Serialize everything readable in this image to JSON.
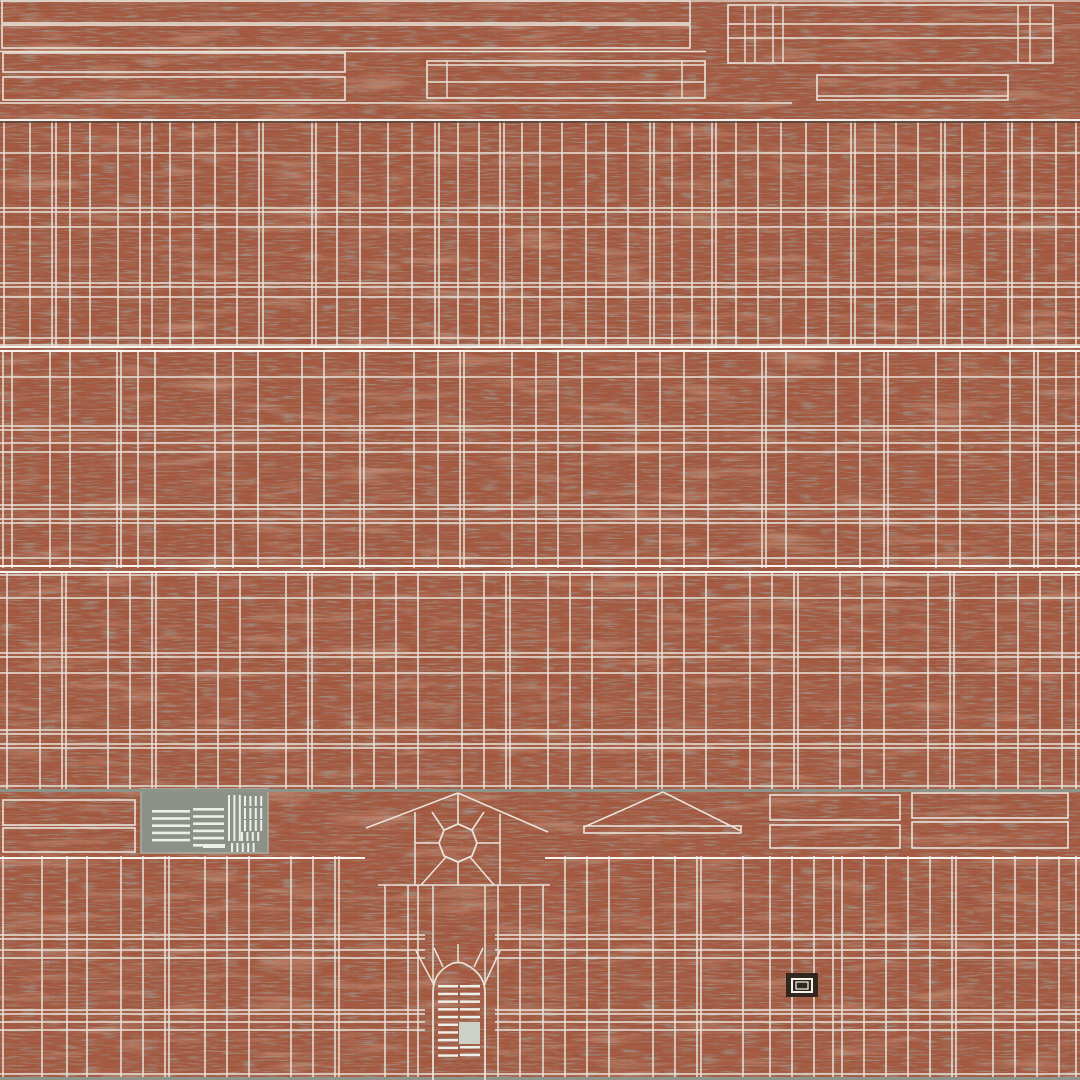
{
  "meta": {
    "description": "Brick building texture atlas with UV wireframe overlay",
    "width": 1080,
    "height": 1080
  },
  "palette": {
    "brick_base": "#a55a41",
    "brick_dark": "#5e4f45",
    "brick_light": "#c67c5b",
    "mortar_shadow": "#4c423a",
    "line": "#e9e3da",
    "line_bright": "#f7f4ef",
    "seam": "#8e948a",
    "panel_gray": "#8c9187",
    "panel_edge": "#a7aca1",
    "slat": "#edefe9",
    "door_block": "#ccd0c7",
    "plaque_dark": "#31271e"
  },
  "wireframe": {
    "bands": [
      {
        "name": "wall-band-upper",
        "y": 120,
        "h": 227,
        "v": [
          4,
          30,
          52,
          56,
          70,
          90,
          118,
          140,
          152,
          170,
          193,
          215,
          237,
          259,
          263,
          312,
          316,
          337,
          360,
          388,
          412,
          435,
          439,
          458,
          479,
          500,
          504,
          522,
          540,
          562,
          586,
          606,
          628,
          650,
          654,
          672,
          692,
          712,
          716,
          736,
          758,
          781,
          806,
          828,
          851,
          855,
          875,
          896,
          918,
          941,
          945,
          962,
          985,
          1008,
          1012,
          1032,
          1056,
          1076
        ],
        "hl": [
          [
            120,
            0,
            1080,
            "line_bright",
            2
          ],
          [
            122,
            0,
            1080,
            "mortar_shadow",
            1.5
          ],
          [
            153,
            0,
            1080
          ],
          [
            208,
            0,
            1080
          ],
          [
            212,
            0,
            1080
          ],
          [
            227,
            0,
            1080
          ],
          [
            283,
            0,
            1080
          ],
          [
            287,
            0,
            1080
          ],
          [
            297,
            0,
            1080
          ],
          [
            338,
            0,
            1080
          ],
          [
            345,
            0,
            1080
          ],
          [
            347,
            0,
            1080,
            "line_bright",
            2
          ]
        ]
      },
      {
        "name": "wall-band-middle",
        "y": 350,
        "h": 218,
        "v": [
          3,
          12,
          50,
          70,
          117,
          121,
          138,
          155,
          215,
          233,
          258,
          302,
          324,
          360,
          364,
          414,
          438,
          460,
          464,
          512,
          536,
          558,
          582,
          636,
          660,
          684,
          708,
          762,
          766,
          786,
          836,
          860,
          884,
          888,
          936,
          960,
          1010,
          1034,
          1038,
          1056,
          1076
        ],
        "hl": [
          [
            351,
            0,
            1080,
            "line_bright",
            2
          ],
          [
            377,
            0,
            1080
          ],
          [
            426,
            0,
            1080
          ],
          [
            430,
            0,
            1080
          ],
          [
            443,
            0,
            1080
          ],
          [
            452,
            0,
            1080
          ],
          [
            505,
            0,
            1080
          ],
          [
            509,
            0,
            1080
          ],
          [
            519,
            0,
            1080
          ],
          [
            523,
            0,
            1080
          ],
          [
            558,
            0,
            1080
          ],
          [
            566,
            0,
            1080,
            "line_bright",
            2
          ]
        ]
      },
      {
        "name": "wall-band-lower",
        "y": 571,
        "h": 219,
        "v": [
          7,
          40,
          62,
          66,
          108,
          130,
          152,
          156,
          196,
          218,
          240,
          286,
          308,
          312,
          352,
          374,
          396,
          418,
          462,
          484,
          506,
          510,
          548,
          570,
          592,
          636,
          658,
          662,
          684,
          706,
          750,
          772,
          794,
          798,
          840,
          862,
          884,
          928,
          950,
          954,
          996,
          1018,
          1040,
          1062,
          1076
        ],
        "hl": [
          [
            572,
            0,
            1080,
            "line_bright",
            2
          ],
          [
            575,
            0,
            1080
          ],
          [
            598,
            0,
            1080
          ],
          [
            653,
            0,
            1080
          ],
          [
            657,
            0,
            1080
          ],
          [
            673,
            0,
            1080
          ],
          [
            730,
            0,
            1080
          ],
          [
            734,
            0,
            1080
          ],
          [
            744,
            0,
            1080
          ],
          [
            748,
            0,
            1080
          ],
          [
            786,
            0,
            1080
          ]
        ]
      },
      {
        "name": "wall-band-bottom",
        "y": 856,
        "h": 224,
        "v": [
          3,
          42,
          67,
          87,
          121,
          143,
          165,
          169,
          205,
          227,
          249,
          291,
          313,
          335,
          339,
          [
            385,
            885
          ],
          [
            408,
            885
          ],
          [
            418,
            885
          ],
          [
            433,
            885,
            985
          ],
          [
            485,
            885,
            985
          ],
          [
            498,
            885
          ],
          [
            520,
            885
          ],
          [
            543,
            885
          ],
          565,
          587,
          609,
          653,
          675,
          697,
          701,
          743,
          770,
          792,
          814,
          833,
          842,
          864,
          886,
          908,
          930,
          952,
          956,
          993,
          1015,
          1037,
          1059,
          1076
        ],
        "hl": [
          [
            858,
            0,
            365,
            "line_bright",
            2
          ],
          [
            858,
            545,
            1080,
            "line_bright",
            2
          ],
          [
            885,
            378,
            550
          ],
          [
            935,
            0,
            425
          ],
          [
            935,
            495,
            1080
          ],
          [
            939,
            0,
            425
          ],
          [
            939,
            495,
            1080
          ],
          [
            950,
            0,
            425
          ],
          [
            950,
            495,
            1080
          ],
          [
            958,
            0,
            425
          ],
          [
            958,
            495,
            1080
          ],
          [
            1010,
            0,
            425
          ],
          [
            1010,
            495,
            1080
          ],
          [
            1014,
            0,
            425
          ],
          [
            1014,
            495,
            1080
          ],
          [
            1022,
            0,
            425
          ],
          [
            1022,
            495,
            1080
          ],
          [
            1030,
            0,
            425
          ],
          [
            1030,
            495,
            1080
          ],
          [
            1074,
            0,
            1080
          ]
        ]
      }
    ],
    "rects": [
      {
        "x": 2,
        "y": 1,
        "w": 688,
        "h": 22,
        "n": "roof-strip-a"
      },
      {
        "x": 2,
        "y": 25,
        "w": 688,
        "h": 23,
        "n": "roof-strip-b"
      },
      {
        "x": 3,
        "y": 53,
        "w": 342,
        "h": 19,
        "n": "trim-strip-left-1"
      },
      {
        "x": 3,
        "y": 77,
        "w": 342,
        "h": 23,
        "n": "trim-strip-left-2"
      },
      {
        "x": 427,
        "y": 61,
        "w": 278,
        "h": 37,
        "n": "trim-strip-center"
      },
      {
        "x": 817,
        "y": 75,
        "w": 191,
        "h": 25,
        "n": "trim-strip-right"
      },
      {
        "x": 728,
        "y": 5,
        "w": 325,
        "h": 58,
        "n": "fascia-block"
      },
      {
        "x": 3,
        "y": 800,
        "w": 132,
        "h": 25,
        "n": "spandrel-left-1"
      },
      {
        "x": 3,
        "y": 828,
        "w": 132,
        "h": 24,
        "n": "spandrel-left-2"
      },
      {
        "x": 770,
        "y": 795,
        "w": 130,
        "h": 25,
        "n": "spandrel-right-1"
      },
      {
        "x": 770,
        "y": 825,
        "w": 130,
        "h": 23,
        "n": "spandrel-right-2"
      },
      {
        "x": 912,
        "y": 793,
        "w": 156,
        "h": 25,
        "n": "spandrel-right-3"
      },
      {
        "x": 912,
        "y": 822,
        "w": 156,
        "h": 26,
        "n": "spandrel-right-4"
      },
      {
        "x": 584,
        "y": 826,
        "w": 157,
        "h": 7,
        "n": "pediment-base"
      },
      {
        "x": 141,
        "y": 789,
        "w": 127,
        "h": 64,
        "fill": "panel_gray",
        "stroke": "panel_edge",
        "n": "entry-panel"
      },
      {
        "x": 203,
        "y": 844,
        "w": 22,
        "h": 4,
        "fill": "slat",
        "stroke": "none",
        "n": "grille-bar"
      },
      {
        "x": 786,
        "y": 973,
        "w": 32,
        "h": 24,
        "fill": "plaque_dark",
        "stroke": "none",
        "n": "plaque"
      },
      {
        "x": 792,
        "y": 979,
        "w": 20,
        "h": 13,
        "stroke": "line_bright",
        "sw": 2,
        "n": "plaque-frame-outer"
      },
      {
        "x": 796,
        "y": 982,
        "w": 12,
        "h": 7,
        "stroke": "line_bright",
        "sw": 1.2,
        "n": "plaque-frame-inner"
      },
      {
        "x": 459,
        "y": 1022,
        "w": 21,
        "h": 22,
        "fill": "door_block",
        "stroke": "none",
        "n": "door-panel-blank"
      }
    ],
    "lines": [
      [
        0,
        1,
        1080,
        1,
        "line",
        1.2,
        "atlas-top-edge"
      ],
      [
        0,
        51.5,
        706,
        51.5,
        "line",
        1.6,
        "trim-rail"
      ],
      [
        427,
        65,
        705,
        65,
        "line",
        1.4,
        "trim-rail"
      ],
      [
        427,
        82,
        705,
        82,
        "line",
        1.4,
        "trim-rail"
      ],
      [
        447,
        61,
        447,
        98,
        "line",
        1.4,
        "trim-mullion"
      ],
      [
        682,
        61,
        682,
        98,
        "line",
        1.4,
        "trim-mullion"
      ],
      [
        817,
        96,
        1008,
        96,
        "line",
        1.4,
        "trim-rail"
      ],
      [
        0,
        103,
        792,
        103,
        "line",
        1.6,
        "trim-rail"
      ],
      [
        728,
        24,
        1053,
        24,
        "line",
        1.4,
        "fascia-rail"
      ],
      [
        728,
        38,
        1053,
        38,
        "line",
        1.4,
        "fascia-rail"
      ],
      [
        745,
        5,
        745,
        63,
        "line",
        1.4,
        "fascia-mullion"
      ],
      [
        755,
        5,
        755,
        63,
        "line",
        1.4,
        "fascia-mullion"
      ],
      [
        773,
        5,
        773,
        63,
        "line",
        1.4,
        "fascia-mullion"
      ],
      [
        783,
        5,
        783,
        63,
        "line",
        1.4,
        "fascia-mullion"
      ],
      [
        1018,
        5,
        1018,
        63,
        "line",
        1.4,
        "fascia-mullion"
      ],
      [
        1030,
        5,
        1030,
        63,
        "line",
        1.4,
        "fascia-mullion"
      ],
      [
        0,
        790.5,
        1080,
        790.5,
        "seam",
        3,
        "seam-line-mid"
      ],
      [
        0,
        1078.5,
        1080,
        1078.5,
        "seam",
        3,
        "seam-line-bottom"
      ],
      [
        458,
        793,
        366,
        828,
        "line",
        1.6,
        "fan-slope"
      ],
      [
        458,
        793,
        548,
        832,
        "line",
        1.6,
        "fan-slope"
      ],
      [
        415,
        812,
        415,
        885,
        "line",
        1.6,
        "fan-side"
      ],
      [
        500,
        814,
        500,
        885,
        "line",
        1.6,
        "fan-side"
      ],
      [
        458,
        793,
        458,
        824,
        "line",
        1.6,
        "fan-spoke"
      ],
      [
        432,
        812,
        444,
        830,
        "line",
        1.6,
        "fan-spoke"
      ],
      [
        415,
        843,
        439,
        843,
        "line",
        1.6,
        "fan-spoke"
      ],
      [
        421,
        885,
        446,
        857,
        "line",
        1.6,
        "fan-spoke"
      ],
      [
        458,
        862,
        458,
        885,
        "line",
        1.6,
        "fan-spoke"
      ],
      [
        494,
        885,
        470,
        857,
        "line",
        1.6,
        "fan-spoke"
      ],
      [
        477,
        843,
        500,
        843,
        "line",
        1.6,
        "fan-spoke"
      ],
      [
        484,
        812,
        472,
        830,
        "line",
        1.6,
        "fan-spoke"
      ],
      [
        663,
        792,
        584,
        827,
        "line",
        1.6,
        "pediment-slope"
      ],
      [
        663,
        792,
        741,
        831,
        "line",
        1.6,
        "pediment-slope"
      ],
      [
        433,
        983,
        416,
        951,
        "line",
        1.5,
        "arch-voussoir"
      ],
      [
        458,
        962,
        458,
        944,
        "line",
        1.5,
        "arch-voussoir"
      ],
      [
        485,
        983,
        500,
        951,
        "line",
        1.5,
        "arch-voussoir"
      ],
      [
        443,
        967,
        434,
        948,
        "line",
        1.5,
        "arch-voussoir"
      ],
      [
        474,
        967,
        483,
        948,
        "line",
        1.5,
        "arch-voussoir"
      ]
    ],
    "paths": [
      {
        "d": "M433,1080 L433,992 C433,976 443,968 451,964 C455,962 461,962 465,964 C473,968 485,976 485,992 L485,1080",
        "n": "door-arch"
      },
      {
        "d": "M458,824 L444,830 L439,843 L444,856 L458,862 L472,856 L477,843 L472,830 Z",
        "n": "fan-hub"
      }
    ],
    "stripes": [
      {
        "x": 438,
        "y": 985,
        "w": 20,
        "h": 77,
        "dir": "h",
        "t": 2.5,
        "g": 5.2,
        "n": "door-louver-left"
      },
      {
        "x": 460,
        "y": 985,
        "w": 20,
        "h": 36,
        "dir": "h",
        "t": 2.5,
        "g": 5.2,
        "n": "door-louver-right-top"
      },
      {
        "x": 460,
        "y": 1046,
        "w": 20,
        "h": 16,
        "dir": "h",
        "t": 2.5,
        "g": 5.2,
        "n": "door-louver-right-bottom"
      },
      {
        "x": 152,
        "y": 810,
        "w": 38,
        "h": 38,
        "dir": "h",
        "t": 2.6,
        "g": 4.6,
        "n": "grille-louver-a"
      },
      {
        "x": 193,
        "y": 808,
        "w": 31,
        "h": 43,
        "dir": "h",
        "t": 2.6,
        "g": 4.6,
        "n": "grille-louver-b"
      },
      {
        "x": 228,
        "y": 795,
        "w": 13,
        "h": 46,
        "dir": "v",
        "t": 2,
        "g": 3.4,
        "n": "grille-vent-tall"
      },
      {
        "x": 244,
        "y": 796,
        "w": 20,
        "h": 10,
        "dir": "v",
        "t": 2,
        "g": 3.4,
        "n": "grille-vent-row-1"
      },
      {
        "x": 244,
        "y": 808,
        "w": 22,
        "h": 11,
        "dir": "v",
        "t": 2,
        "g": 3.4,
        "n": "grille-vent-row-2"
      },
      {
        "x": 244,
        "y": 820,
        "w": 22,
        "h": 11,
        "dir": "v",
        "t": 2,
        "g": 3.4,
        "n": "grille-vent-row-3"
      },
      {
        "x": 241,
        "y": 832,
        "w": 20,
        "h": 9,
        "dir": "v",
        "t": 2,
        "g": 3.4,
        "n": "grille-vent-row-4"
      },
      {
        "x": 231,
        "y": 843,
        "w": 27,
        "h": 9,
        "dir": "v",
        "t": 2,
        "g": 3.4,
        "n": "grille-vent-bottom"
      }
    ]
  }
}
